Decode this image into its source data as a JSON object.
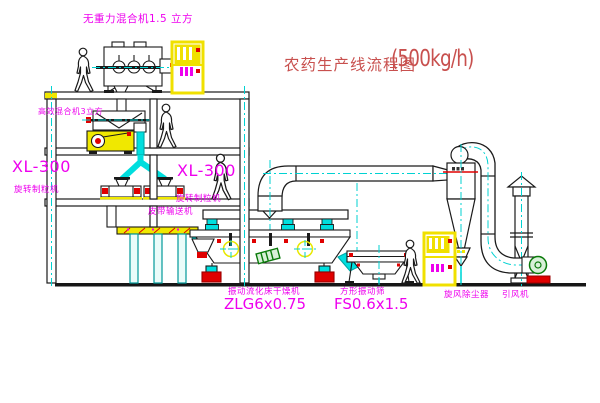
{
  "title": {
    "text_cn": "农药生产线流程图",
    "capacity": "(500kg/h)"
  },
  "labels": {
    "gravity_mixer": "无重力混合机1.5 立方",
    "high_mixer": "高效混合机3立方",
    "granulator_left_model": "XL-300",
    "granulator_left_name": "旋转制粒机",
    "granulator_right_model": "XL-300",
    "granulator_right_name": "旋转制粒机",
    "belt_conveyor": "皮带输送机",
    "dryer_name": "振动流化床干燥机",
    "dryer_model": "ZLG6x0.75",
    "screen_name": "方形振动筛",
    "screen_model": "FS0.6x1.5",
    "cyclone": "旋风除尘器",
    "fan": "引风机"
  },
  "colors": {
    "label_magenta": "#ee00ee",
    "title_red": "#c8504e",
    "line_cyan": "#00d2d2",
    "equip_yellow": "#f0e800",
    "accent_red": "#e00000",
    "accent_green": "#0a7a0a",
    "line_black": "#1a1a1a",
    "background": "#ffffff"
  }
}
